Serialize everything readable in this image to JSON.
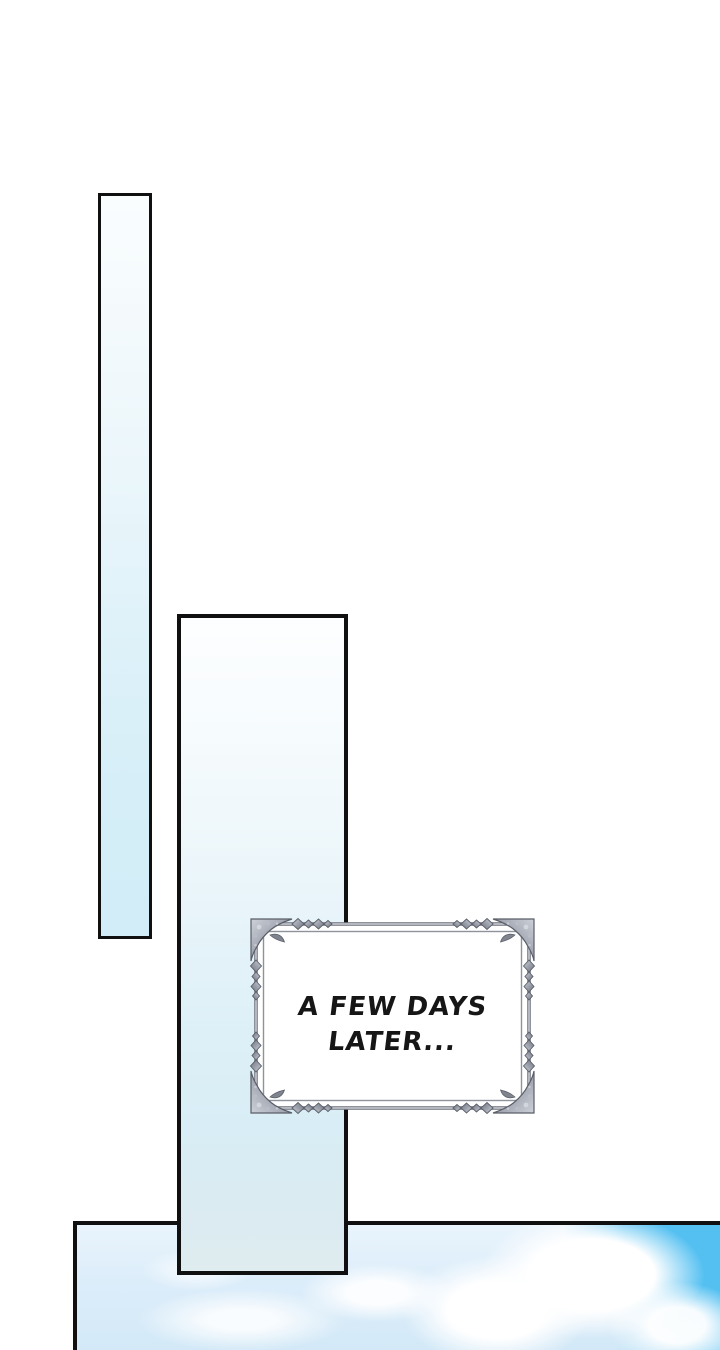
{
  "caption": {
    "line1": "A FEW DAYS",
    "line2": "LATER..."
  },
  "colors": {
    "page_background": "#ffffff",
    "panel_border": "#101010",
    "panel_gradient_top": "#fbfdfe",
    "panel_gradient_bottom": "#d2edf8",
    "frame_silver": "#9298a3",
    "frame_silver_dark": "#5a5e68",
    "frame_fill": "#ffffff",
    "sky_bright_blue": "#54c0f1",
    "sky_pale_blue": "#d9ecf9",
    "cloud_white": "#ffffff",
    "caption_text_color": "#161616"
  }
}
